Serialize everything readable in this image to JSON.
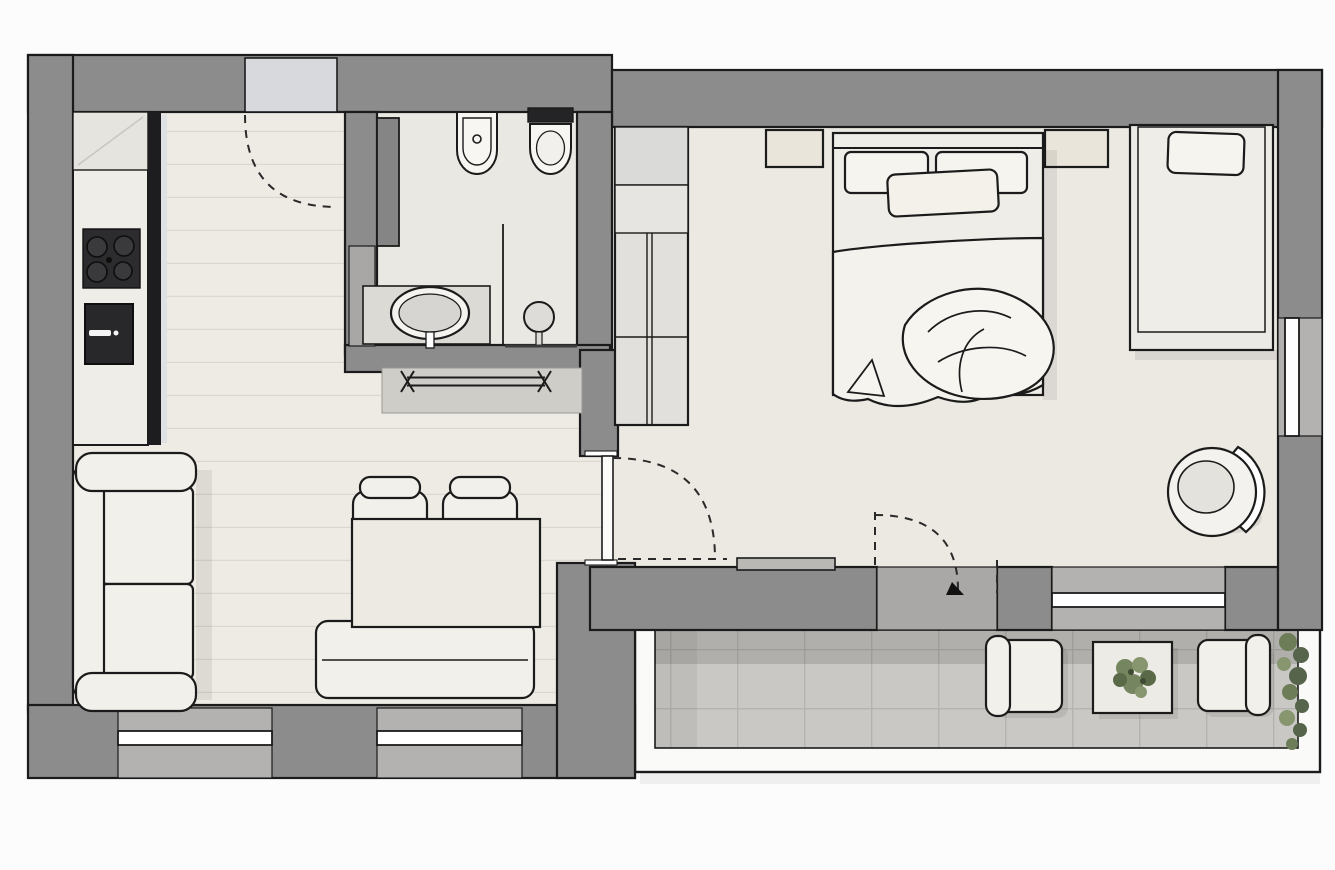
{
  "meta": {
    "kind": "apartment-floor-plan",
    "view": "top-down rendered architectural drawing",
    "rooms": [
      {
        "id": "kitchen-living",
        "features": [
          "kitchen-counter",
          "cooktop",
          "oven",
          "sofa",
          "dining-table",
          "dining-chairs",
          "dining-bench",
          "entrance-door",
          "two-windows"
        ]
      },
      {
        "id": "bathroom",
        "features": [
          "bidet",
          "toilet",
          "vanity-sink",
          "shower",
          "tall-cabinet",
          "sliding-door",
          "towel-radiator"
        ]
      },
      {
        "id": "bedroom",
        "features": [
          "wardrobe",
          "double-bed",
          "two-nightstands",
          "single-daybed",
          "swivel-chair",
          "hinged-door",
          "balcony-door",
          "two-windows"
        ]
      },
      {
        "id": "balcony",
        "features": [
          "tiled-floor",
          "railing",
          "two-outdoor-armchairs",
          "coffee-table",
          "plants"
        ]
      }
    ]
  },
  "colors": {
    "background": "#fcfcfc",
    "wall": "#8d8c8d",
    "wall_recess": "#a9a8a6",
    "wall_window_zone": "#b3b2b0",
    "outline": "#1b1b1b",
    "floor_wood": "#eeebe5",
    "plank_line": "#dcd8d1",
    "floor_bath": "#eae8e2",
    "floor_bedroom": "#ece9e3",
    "balcony_tile": "#c9c8c4",
    "tile_line": "#b4b3af",
    "railing": "#fafaf8",
    "furniture_light": "#f2f0ea",
    "furniture_mid": "#e2e0dc",
    "counter_top": "#efede8",
    "appliance_dark": "#28282a",
    "cooktop": "#2c2c2e",
    "door_panel": "#d8d9dd",
    "glass": "#ffffff",
    "fixture_white": "#f7f6f3",
    "basin_gray": "#d7d5d1",
    "bench_gray": "#cfcdc8",
    "plant_green": "#75855f",
    "plant_green_dark": "#55644a",
    "dash_line": "#2a2a2a"
  }
}
